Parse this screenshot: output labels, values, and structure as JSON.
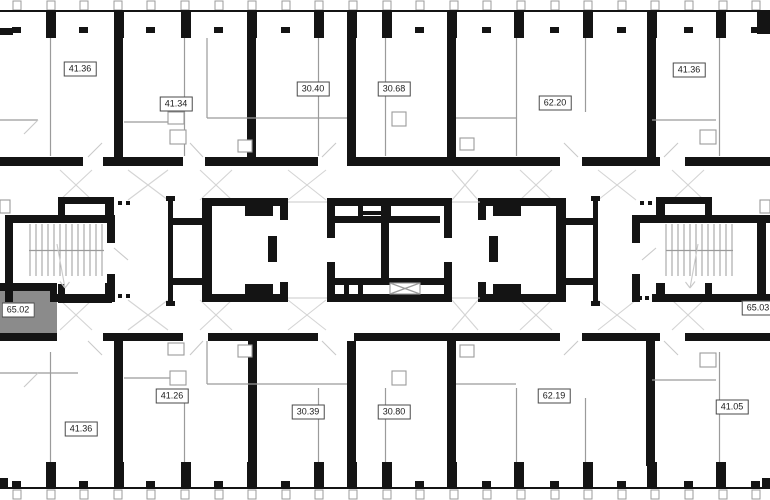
{
  "plan": {
    "name": "residential-floor-plan",
    "units": [
      {
        "id": "top-1",
        "area": "41.36",
        "x": 80,
        "y": 69
      },
      {
        "id": "top-2",
        "area": "41.34",
        "x": 176,
        "y": 104
      },
      {
        "id": "top-3",
        "area": "30.40",
        "x": 313,
        "y": 89
      },
      {
        "id": "top-4",
        "area": "30.68",
        "x": 394,
        "y": 89
      },
      {
        "id": "top-5",
        "area": "62.20",
        "x": 555,
        "y": 103
      },
      {
        "id": "top-6",
        "area": "41.36",
        "x": 689,
        "y": 70
      },
      {
        "id": "mid-left",
        "area": "65.02",
        "x": 18,
        "y": 310,
        "highlight": true
      },
      {
        "id": "mid-right",
        "area": "65.03",
        "x": 758,
        "y": 308
      },
      {
        "id": "bottom-1",
        "area": "41.36",
        "x": 81,
        "y": 429
      },
      {
        "id": "bottom-2",
        "area": "41.26",
        "x": 172,
        "y": 396
      },
      {
        "id": "bottom-3",
        "area": "30.39",
        "x": 308,
        "y": 412
      },
      {
        "id": "bottom-4",
        "area": "30.80",
        "x": 394,
        "y": 412
      },
      {
        "id": "bottom-5",
        "area": "62.19",
        "x": 554,
        "y": 396
      },
      {
        "id": "bottom-6",
        "area": "41.05",
        "x": 732,
        "y": 407
      }
    ],
    "colors": {
      "wall": "#141414",
      "partition": "#9b9b9b",
      "swing": "#c9c9c9",
      "chevron": "#d4d4d4",
      "highlight": "#8b8b8b",
      "label_border": "#4a4a4a",
      "label_bg": "#ffffff",
      "label_text": "#1b1b1b",
      "background": "#ffffff"
    }
  }
}
